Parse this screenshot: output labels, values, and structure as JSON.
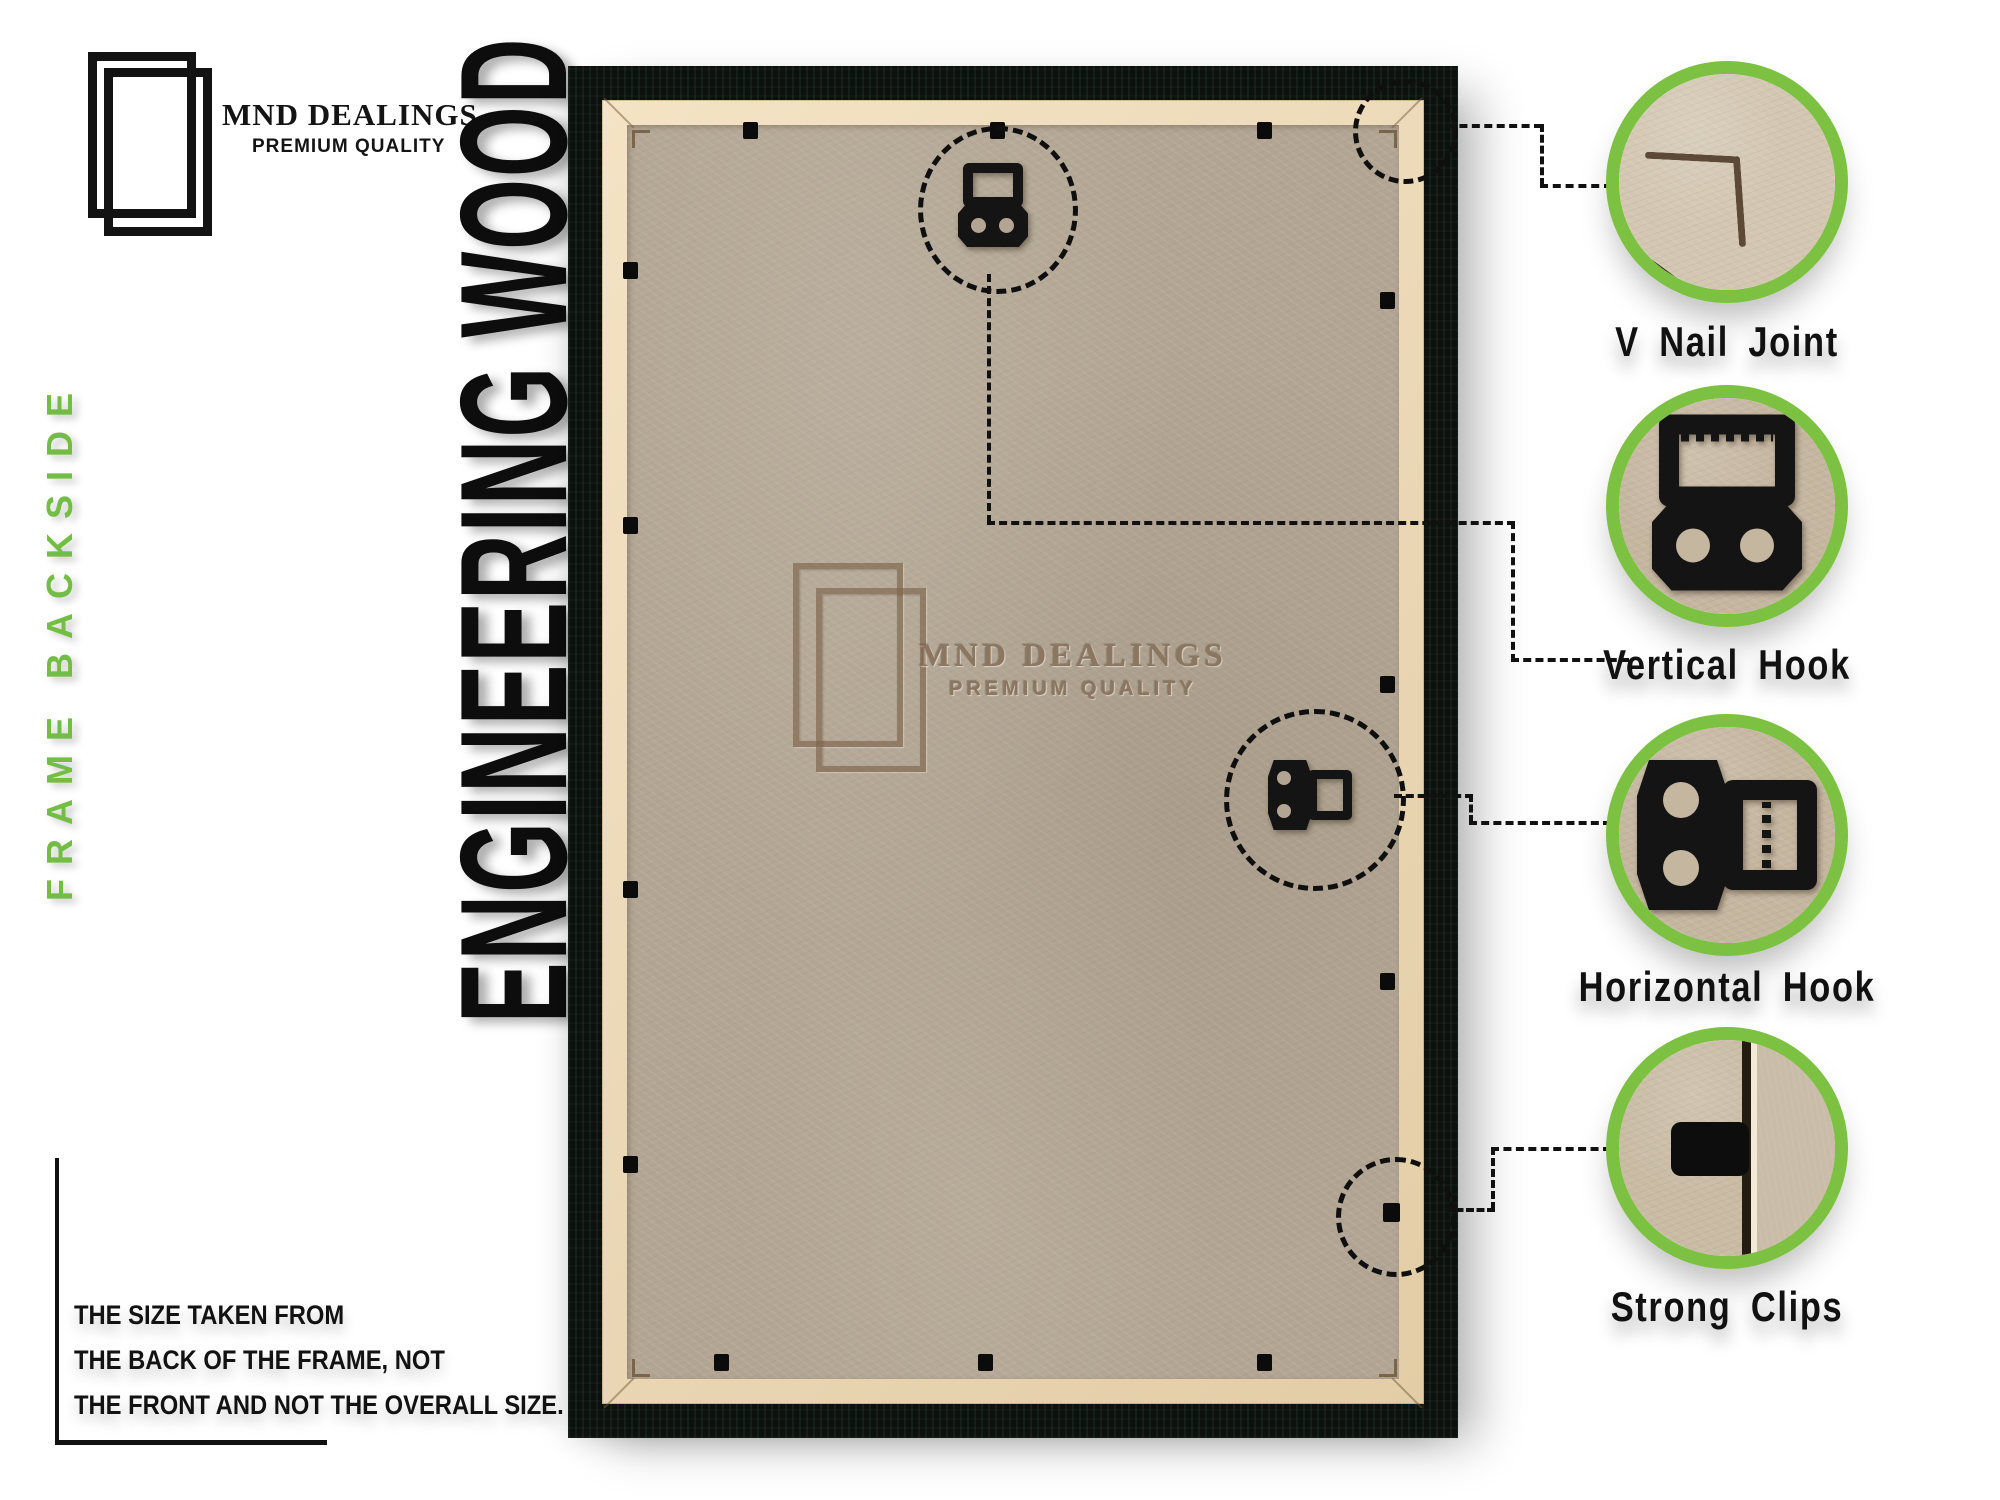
{
  "brand": {
    "name": "MND DEALINGS",
    "tagline": "PREMIUM QUALITY"
  },
  "side_label": "FRAME BACKSIDE",
  "material_label": "ENGINEERING WOOD",
  "watermark": {
    "name": "MND DEALINGS",
    "tagline": "PREMIUM QUALITY"
  },
  "size_note": {
    "lines": [
      "THE SIZE TAKEN FROM",
      "THE BACK OF THE FRAME, NOT",
      "THE FRONT AND NOT THE OVERALL SIZE."
    ]
  },
  "callouts": [
    {
      "label": "V Nail Joint"
    },
    {
      "label": "Vertical Hook"
    },
    {
      "label": "Horizontal Hook"
    },
    {
      "label": "Strong Clips"
    }
  ],
  "colors": {
    "accent_green": "#7cc142",
    "text_green": "#74bd44",
    "frame_black": "#0c110e",
    "mdf_board": "#b2a593",
    "tan_lip": "#ecd9b8",
    "emboss_brown": "#8b7660"
  }
}
